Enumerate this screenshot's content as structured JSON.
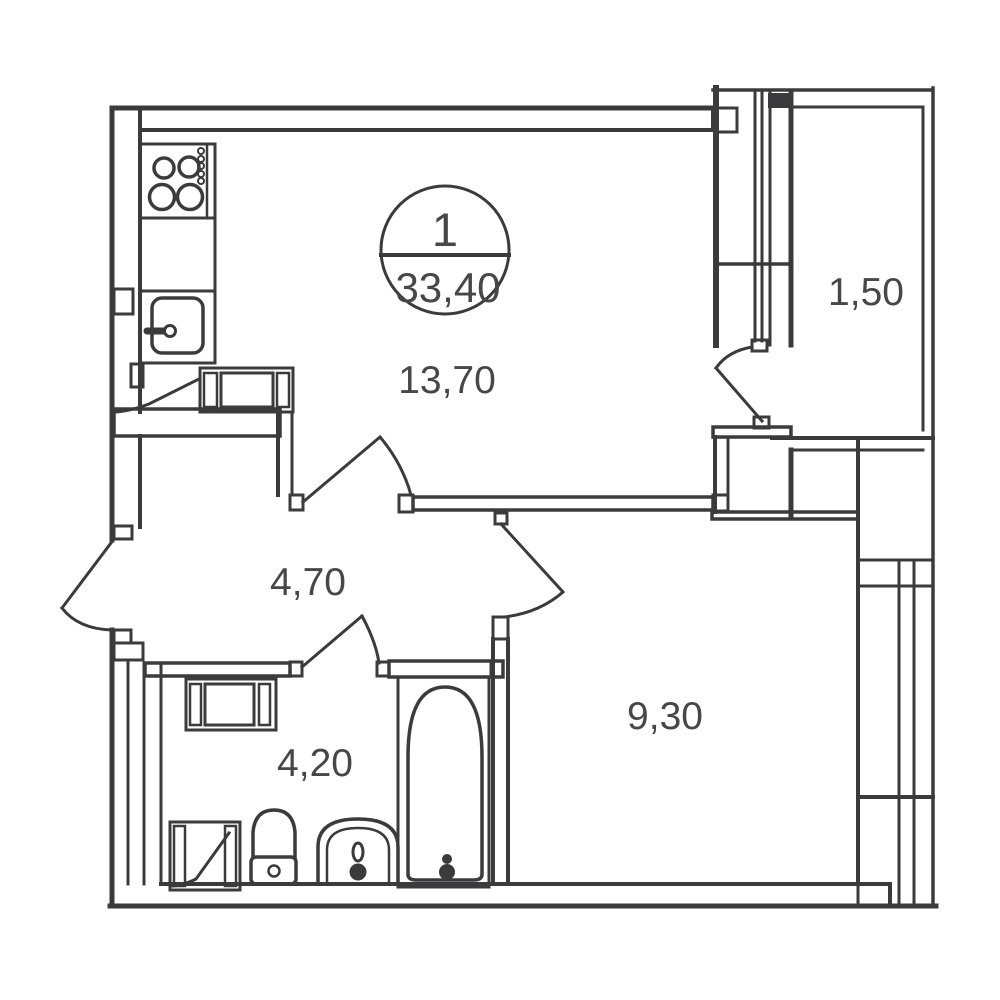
{
  "plan": {
    "apartment_stamp": {
      "rooms_count": "1",
      "total_area": "33,40"
    },
    "rooms": [
      {
        "name": "kitchen-living-room",
        "area": "13,70"
      },
      {
        "name": "loggia",
        "area": "1,50"
      },
      {
        "name": "hallway",
        "area": "4,70"
      },
      {
        "name": "bathroom",
        "area": "4,20"
      },
      {
        "name": "bedroom",
        "area": "9,30"
      }
    ],
    "fixtures": [
      "stove",
      "kitchen-sink",
      "kitchen-counter",
      "wardrobe",
      "washing-machine",
      "toilet",
      "washbasin",
      "bathtub",
      "shower-frame"
    ],
    "colors": {
      "line": "#3b3b3d",
      "text": "#474747",
      "background": "#ffffff"
    }
  }
}
